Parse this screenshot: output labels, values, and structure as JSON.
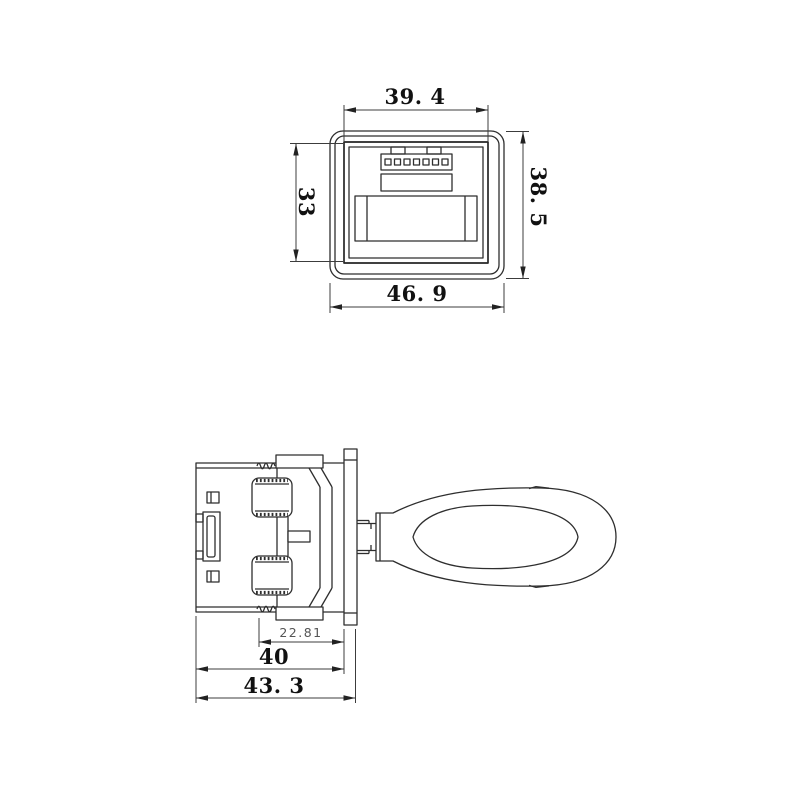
{
  "drawing": {
    "front_view": {
      "dim_inner_width": "39. 4",
      "dim_inner_height": "33",
      "dim_outer_height": "38. 5",
      "dim_outer_width": "46. 9"
    },
    "side_view": {
      "dim_clip_depth": "22.81",
      "dim_body_depth": "40",
      "dim_overall_depth": "43. 3"
    },
    "colors": {
      "line": "#2e2e2e",
      "dimension_line": "#3c3c3c",
      "text": "#111111",
      "small_text": "#555555",
      "background": "#ffffff"
    }
  }
}
